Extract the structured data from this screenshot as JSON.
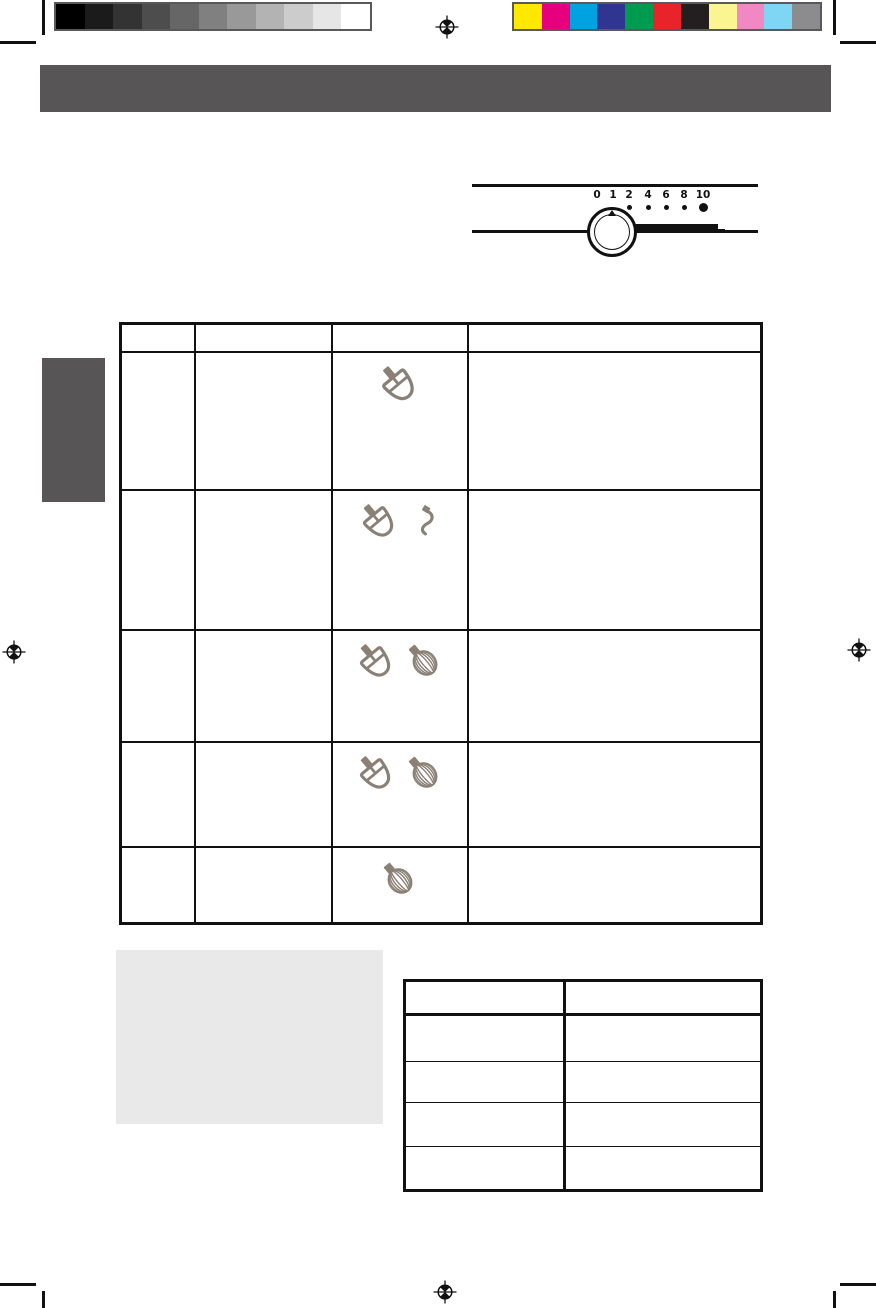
{
  "document_type": "scanned manual page",
  "print_marks": {
    "grayscale_bar_colors": [
      "#000000",
      "#1b1b1b",
      "#333333",
      "#4d4d4d",
      "#666666",
      "#808080",
      "#999999",
      "#b3b3b3",
      "#cccccc",
      "#e6e6e6",
      "#ffffff"
    ],
    "color_bar_colors": [
      "#ffe900",
      "#e6007e",
      "#00a3e0",
      "#2f3590",
      "#009b4e",
      "#e8232a",
      "#231f20",
      "#faf491",
      "#f088c3",
      "#7fd5f4",
      "#8c8c8e"
    ],
    "bar_border_color": "#58595b",
    "registration_marks": [
      "top-center",
      "left-middle",
      "right-middle",
      "bottom-center"
    ],
    "crop_marks": [
      "top-left",
      "top-right",
      "bottom-left",
      "bottom-right"
    ]
  },
  "header_bar": {
    "color": "#575556",
    "title": ""
  },
  "side_tab": {
    "color": "#575556"
  },
  "speed_control": {
    "labels": [
      "0",
      "1",
      "2",
      "4",
      "6",
      "8",
      "10"
    ],
    "dots": [
      {
        "label": "2",
        "size": "small"
      },
      {
        "label": "4",
        "size": "small"
      },
      {
        "label": "6",
        "size": "small"
      },
      {
        "label": "8",
        "size": "small"
      },
      {
        "label": "10",
        "size": "large"
      }
    ],
    "knob": "rotary-dial-knob with pointer at speed 1"
  },
  "main_table": {
    "icon_color": "#8a8076",
    "column_count": 4,
    "header_cells": [
      "",
      "",
      "",
      ""
    ],
    "rows": [
      {
        "icons": [
          "flat-beater-icon"
        ]
      },
      {
        "icons": [
          "flat-beater-icon",
          "dough-hook-icon"
        ]
      },
      {
        "icons": [
          "flat-beater-icon",
          "whisk-icon"
        ]
      },
      {
        "icons": [
          "flat-beater-icon",
          "whisk-icon"
        ]
      },
      {
        "icons": [
          "whisk-icon"
        ]
      }
    ]
  },
  "notice_box": {
    "color": "#e9e9e9",
    "text": ""
  },
  "bottom_table": {
    "column_count": 2,
    "header_cells": [
      "",
      ""
    ],
    "data_row_count": 4
  }
}
